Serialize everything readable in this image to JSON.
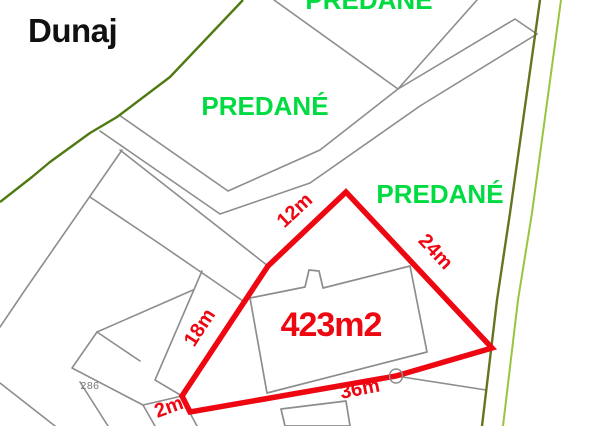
{
  "labels": {
    "region": "Dunaj",
    "sold_top": "PREDANÉ",
    "sold_middle": "PREDANÉ",
    "sold_right": "PREDANÉ",
    "area": "423m2",
    "dim_top": "12m",
    "dim_left": "18m",
    "dim_bottom_left": "2m",
    "dim_bottom": "36m",
    "dim_right": "24m",
    "parcel_number": "286"
  },
  "colors": {
    "highlight_red": "#ee0611",
    "sold_green": "#00db41",
    "region_black": "#111111",
    "parcel_gray": "#8d8d8d",
    "parcel_number_gray": "#777777",
    "boundary_dark_green": "#4f7a12",
    "boundary_olive": "#66731f",
    "boundary_lime": "#96c63c"
  }
}
